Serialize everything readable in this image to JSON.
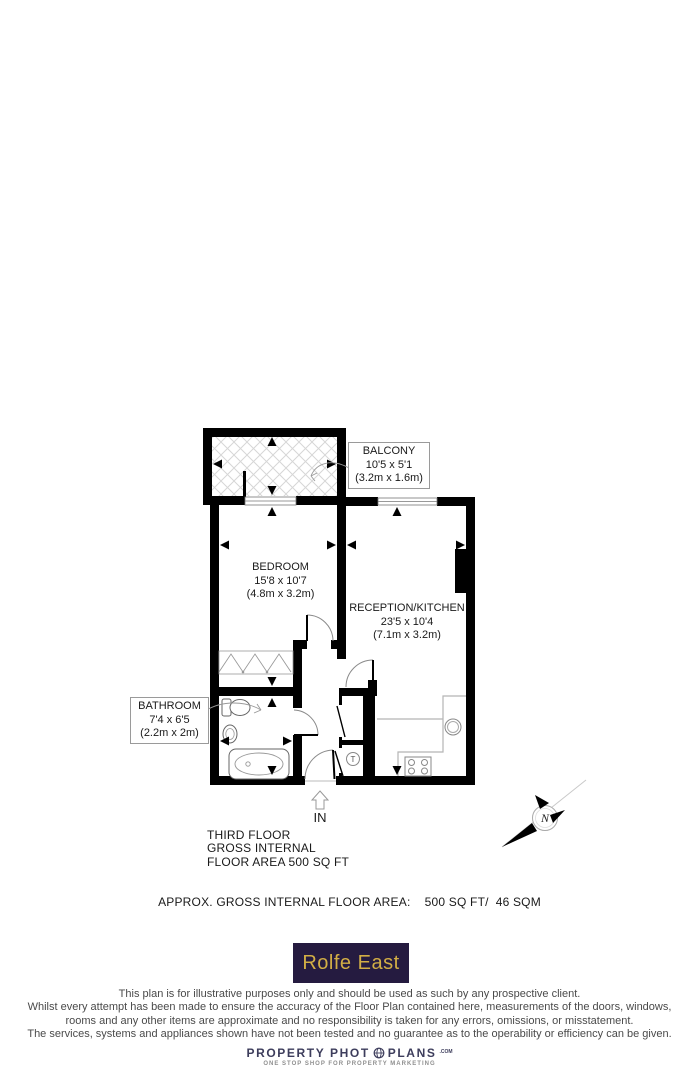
{
  "plan": {
    "rooms": {
      "balcony": {
        "name": "BALCONY",
        "imperial": "10'5 x 5'1",
        "metric": "(3.2m x 1.6m)"
      },
      "bedroom": {
        "name": "BEDROOM",
        "imperial": "15'8 x 10'7",
        "metric": "(4.8m x 3.2m)"
      },
      "reception": {
        "name": "RECEPTION/KITCHEN",
        "imperial": "23'5 x 10'4",
        "metric": "(7.1m x 3.2m)"
      },
      "bathroom": {
        "name": "BATHROOM",
        "imperial": "7'4 x 6'5",
        "metric": "(2.2m x 2m)"
      }
    },
    "entrance_label": "IN",
    "tank_label": "T",
    "compass_label": "N"
  },
  "floor_info": {
    "line1": "THIRD FLOOR",
    "line2": "GROSS INTERNAL",
    "line3": "FLOOR AREA 500 SQ FT"
  },
  "area_summary": "APPROX. GROSS INTERNAL FLOOR AREA:    500 SQ FT/  46 SQM",
  "agent_logo": {
    "text": "Rolfe East",
    "bg_color": "#251b40",
    "text_color": "#d2ae45"
  },
  "disclaimer": {
    "lines": [
      "This plan is for illustrative purposes only and should be used as such by any prospective client.",
      "Whilst every attempt has been made to ensure the accuracy of the Floor Plan contained here, measurements of the doors, windows,",
      "rooms and any other items are approximate and no responsibility is taken for any errors, omissions, or misstatement.",
      "The services, systems and appliances shown have not been tested and no guarantee as to the operability or efficiency can be given."
    ]
  },
  "branding": {
    "name_part1": "PROPERTY PHOT",
    "name_part2": "PLANS",
    "suffix": ".COM",
    "tagline": "ONE STOP SHOP FOR PROPERTY MARKETING"
  }
}
